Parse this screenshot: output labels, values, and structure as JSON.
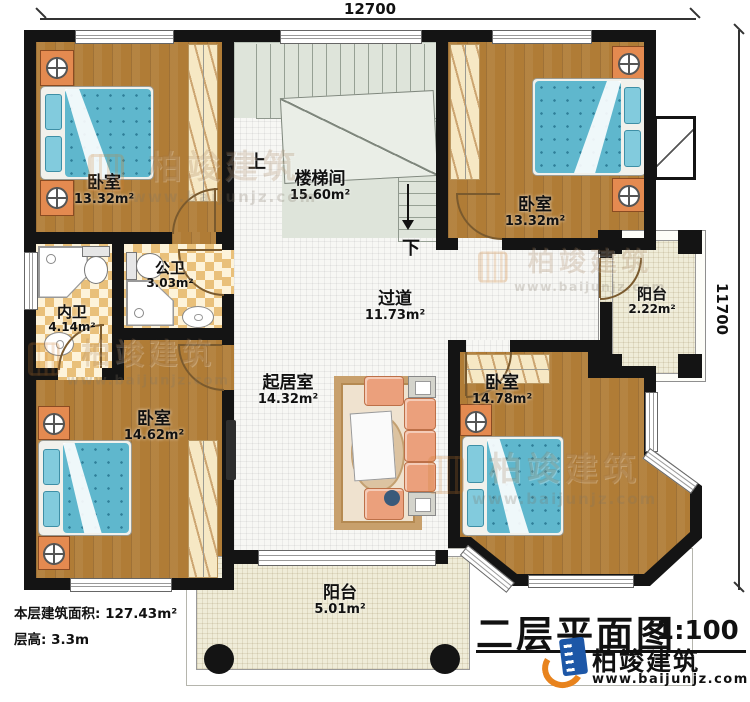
{
  "dimensions": {
    "top": "12700",
    "right": "11700"
  },
  "stairs": {
    "up": "上",
    "down": "下"
  },
  "rooms": {
    "bedroom_tl": {
      "name": "卧室",
      "area": "13.32m²"
    },
    "stairwell": {
      "name": "楼梯间",
      "area": "15.60m²"
    },
    "bedroom_tr": {
      "name": "卧室",
      "area": "13.32m²"
    },
    "bath_inner": {
      "name": "内卫",
      "area": "4.14m²"
    },
    "bath_public": {
      "name": "公卫",
      "area": "3.03m²"
    },
    "hallway": {
      "name": "过道",
      "area": "11.73m²"
    },
    "balcony_right": {
      "name": "阳台",
      "area": "2.22m²"
    },
    "living": {
      "name": "起居室",
      "area": "14.32m²"
    },
    "bedroom_bl": {
      "name": "卧室",
      "area": "14.62m²"
    },
    "bedroom_br": {
      "name": "卧室",
      "area": "14.78m²"
    },
    "balcony_bottom": {
      "name": "阳台",
      "area": "5.01m²"
    }
  },
  "info": {
    "floor_area": "本层建筑面积: 127.43m²",
    "floor_height": "层高: 3.3m"
  },
  "title_block": {
    "title": "二层平面图",
    "scale": "1:100",
    "brand": "柏竣建筑",
    "website": "www.baijunjz.com"
  },
  "watermark": {
    "brand": "柏竣建筑",
    "website": "www.baijunjz.com"
  },
  "colors": {
    "wall": "#141414",
    "wood": "#b07c36",
    "bed": "#5fb7cd",
    "cabinet": "#f6e8c4",
    "nightstand": "#e48a50",
    "tile_dark": "#e9c07a",
    "tile_light": "#fdf3da",
    "stair": "#dee4da",
    "logo_blue": "#1d57a7",
    "logo_orange": "#e8831d"
  }
}
